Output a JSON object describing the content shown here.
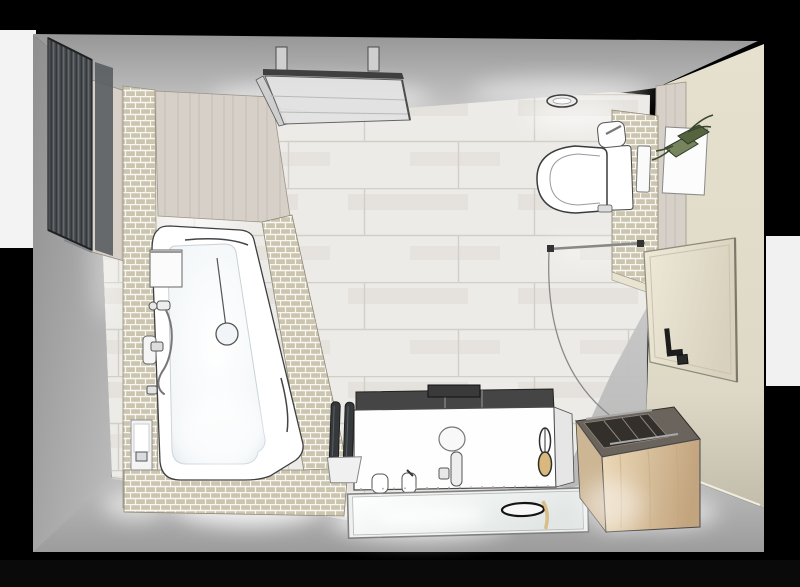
{
  "scene": {
    "type": "3d-architectural-render",
    "view": "top-down bathroom floor plan",
    "room": "bathroom"
  },
  "fixtures": [
    {
      "id": "radiator",
      "label": "vertical designer radiator"
    },
    {
      "id": "bathtub",
      "label": "asymmetric corner bathtub"
    },
    {
      "id": "bath-mixer",
      "label": "hand shower and bath mixer"
    },
    {
      "id": "tub-surround",
      "label": "mosaic tiled tub surround"
    },
    {
      "id": "niche",
      "label": "storage niche with towel"
    },
    {
      "id": "ceiling-panel",
      "label": "ceiling mounted glass panel"
    },
    {
      "id": "ceiling-light",
      "label": "recessed ceiling light"
    },
    {
      "id": "toilet",
      "label": "wall-hung toilet"
    },
    {
      "id": "flush-plate",
      "label": "flush plate"
    },
    {
      "id": "roll-holder",
      "label": "toilet roll holder"
    },
    {
      "id": "plant-shelf",
      "label": "wall shelf with green plant"
    },
    {
      "id": "door",
      "label": "entrance door with swing arc"
    },
    {
      "id": "vanity",
      "label": "washbasin vanity unit"
    },
    {
      "id": "basin",
      "label": "countertop basin with tall faucet"
    },
    {
      "id": "mirror",
      "label": "wall mirror"
    },
    {
      "id": "brush-set",
      "label": "twin brush stand"
    },
    {
      "id": "bench",
      "label": "wooden storage bench"
    },
    {
      "id": "floor",
      "label": "wood-look plank tile floor"
    }
  ],
  "palette": {
    "bg": "#000000",
    "backdrop": "#f3f3f3",
    "ceiling-dark": "#969696",
    "ceiling-light": "#c9c9c9",
    "wall-gray": "#9a9a9a",
    "wall-gray-light": "#bdbdbd",
    "wall-cream": "#ded9c6",
    "wall-cream-dark": "#c2bdab",
    "floor-wood": "#edebe7",
    "floor-line": "#d3cfc8",
    "floor-gray": "#b5b5b5",
    "mosaic": "#cbc5af",
    "mosaic-line": "#f7f6f1",
    "wood-panel": "#d6d0c8",
    "radiator": "#4c5053",
    "radiator-slat": "#2e3134",
    "pure-white": "#ffffff",
    "tub-shade": "#dde4e9",
    "outline": "#3f3f3f",
    "chrome": "#9aa0a4",
    "oak-light": "#ecd9b8",
    "oak-dark": "#c2a47e",
    "bench-top": "#6a645d",
    "door-face": "#efe9d8",
    "door-edge": "#8f8a7c",
    "plant-green": "#77855e",
    "plant-dark": "#55633f",
    "leaf": "#3a4a2c",
    "accent-tan": "#d8b87c"
  }
}
